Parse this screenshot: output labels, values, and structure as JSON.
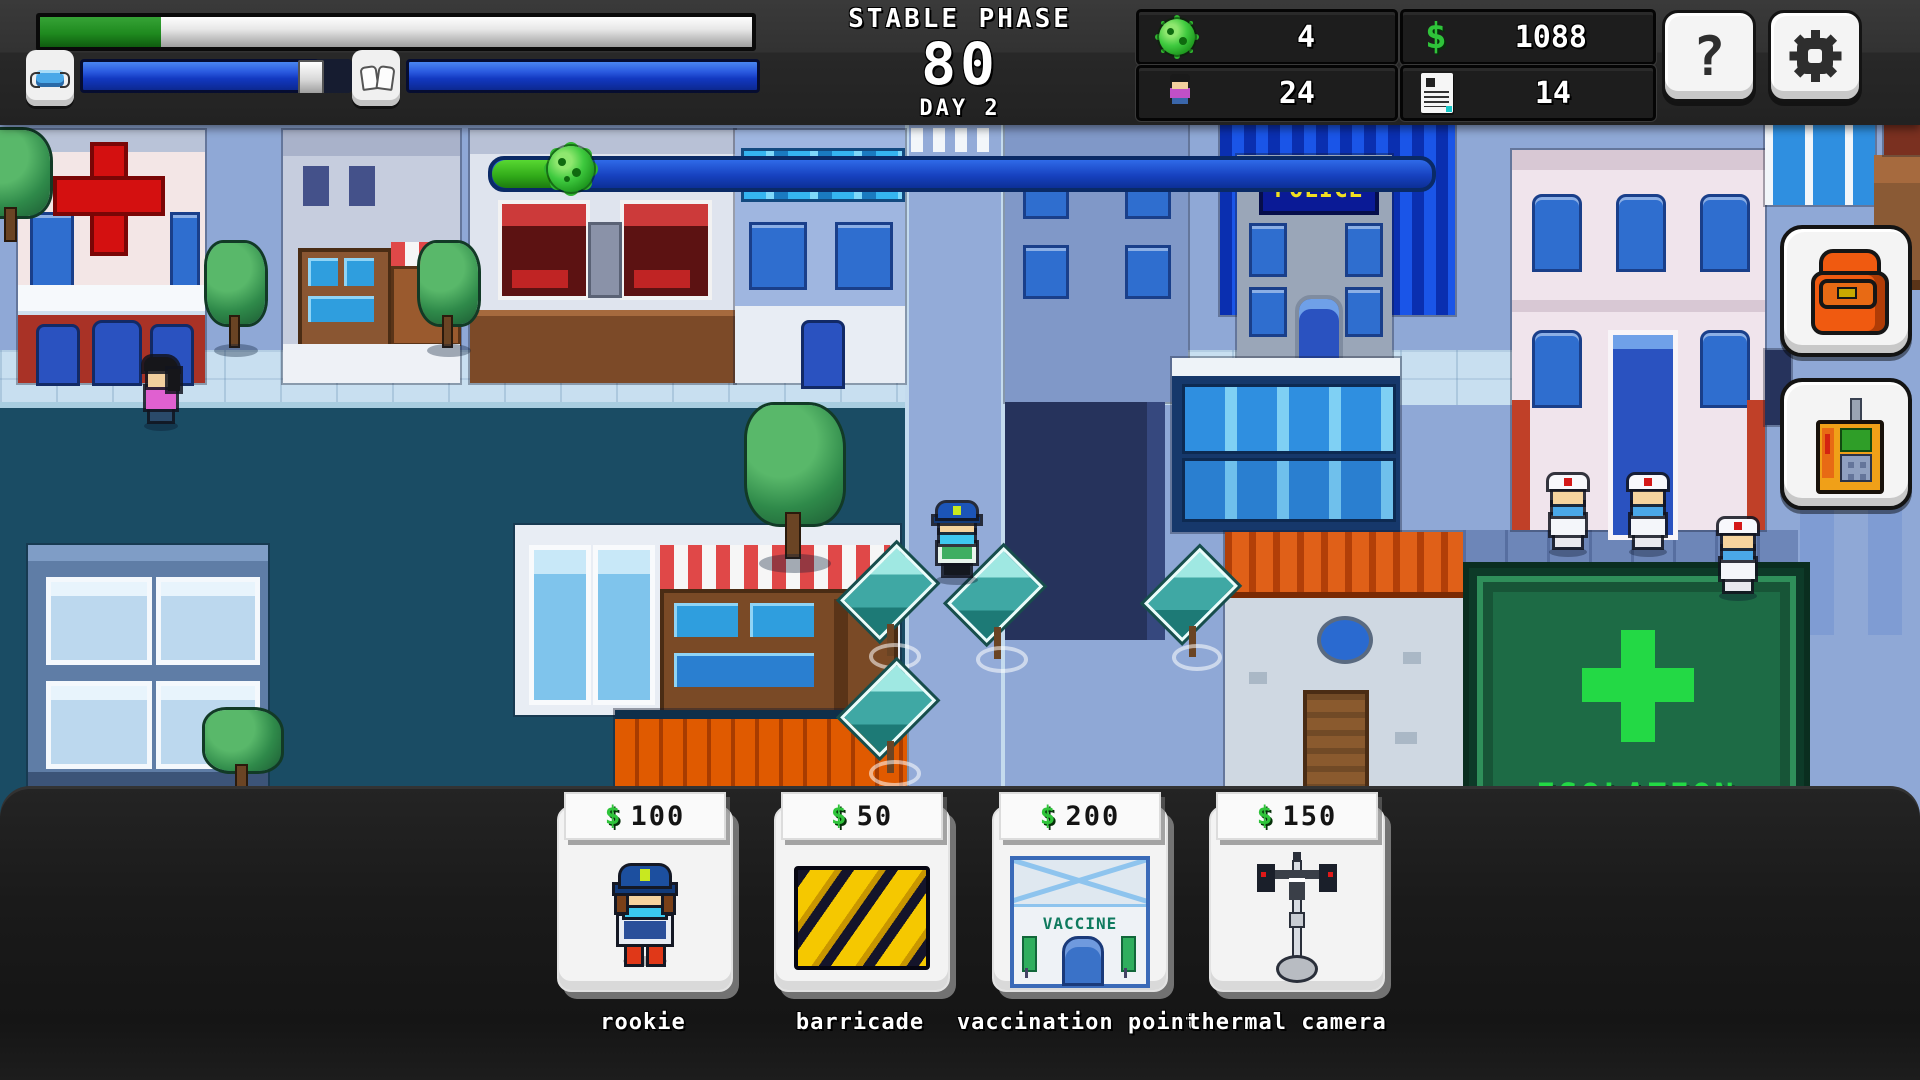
{
  "hud": {
    "phase_label": "STABLE PHASE",
    "phase_value": "80",
    "day_label": "DAY 2",
    "health_percent": 17,
    "mask_percent": 88,
    "hygiene_percent": 100,
    "resources": [
      {
        "id": "virus-samples",
        "icon": "virus-icon",
        "value": "4"
      },
      {
        "id": "population",
        "icon": "citizen-icon",
        "value": "24"
      },
      {
        "id": "money",
        "icon": "dollar-icon",
        "currency": "$",
        "value": "1088"
      },
      {
        "id": "reports",
        "icon": "report-icon",
        "value": "14"
      }
    ],
    "help_label": "?",
    "buttons": [
      {
        "id": "help",
        "icon": "question-icon"
      },
      {
        "id": "settings",
        "icon": "gear-icon"
      }
    ]
  },
  "map": {
    "infection_progress_percent": 8,
    "police_sign": "POLICE",
    "isolation_sign": "ISOLATION"
  },
  "side_buttons": [
    {
      "id": "inventory",
      "icon": "backpack-icon"
    },
    {
      "id": "detector",
      "icon": "radio-detector-icon"
    }
  ],
  "shop": {
    "cards": [
      {
        "name": "rookie",
        "currency": "$",
        "price": "100"
      },
      {
        "name": "barricade",
        "currency": "$",
        "price": "50"
      },
      {
        "name": "vaccination point",
        "currency": "$",
        "price": "200",
        "art_label": "VACCINE"
      },
      {
        "name": "thermal camera",
        "currency": "$",
        "price": "150"
      }
    ]
  },
  "colors": {
    "hud_bg": "#2a2a2a",
    "health_green": "#1f8a1f",
    "bar_blue": "#1238c0",
    "money_green": "#2fc43a",
    "panel_bg": "#1a1a1a",
    "isolation_green": "#28d848",
    "police_sign_bg": "#0a1a96",
    "police_sign_text": "#f0e020",
    "plaza_teal": "#1a4c64",
    "street_blue": "#8fa8d6"
  }
}
